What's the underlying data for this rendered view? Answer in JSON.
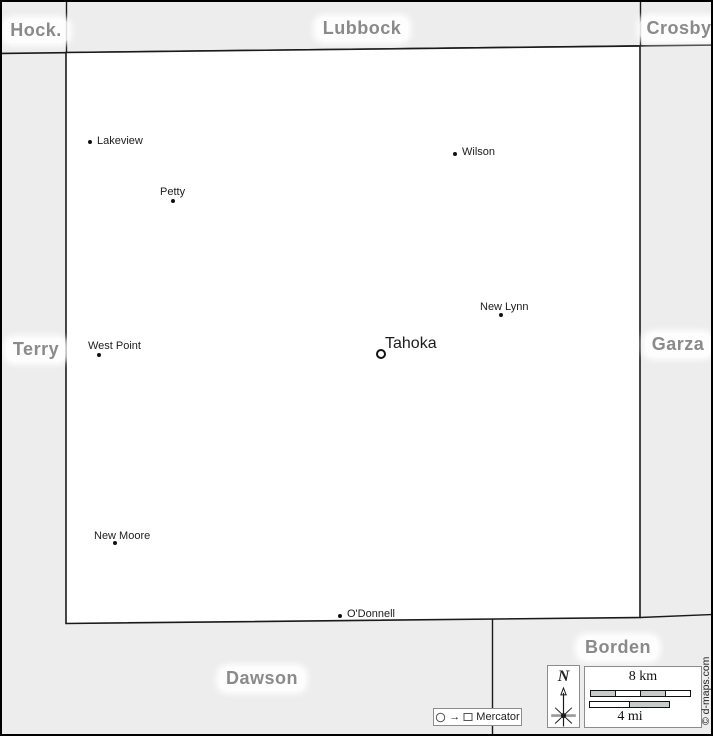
{
  "counties": [
    {
      "name": "Hock.",
      "cx": 34,
      "cy": 17
    },
    {
      "name": "Lubbock",
      "cx": 360,
      "cy": 15
    },
    {
      "name": "Crosby",
      "cx": 677,
      "cy": 15
    },
    {
      "name": "Terry",
      "cx": 34,
      "cy": 336
    },
    {
      "name": "Garza",
      "cx": 676,
      "cy": 331
    },
    {
      "name": "Dawson",
      "cx": 260,
      "cy": 665
    },
    {
      "name": "Borden",
      "cx": 616,
      "cy": 634
    }
  ],
  "towns": [
    {
      "name": "Lakeview",
      "seat": false,
      "dot_x": 88,
      "dot_y": 140,
      "label_x": 95,
      "label_y": 133
    },
    {
      "name": "Petty",
      "seat": false,
      "dot_x": 171,
      "dot_y": 199,
      "label_x": 158,
      "label_y": 184
    },
    {
      "name": "Wilson",
      "seat": false,
      "dot_x": 453,
      "dot_y": 152,
      "label_x": 460,
      "label_y": 144
    },
    {
      "name": "New Lynn",
      "seat": false,
      "dot_x": 499,
      "dot_y": 313,
      "label_x": 478,
      "label_y": 299
    },
    {
      "name": "West Point",
      "seat": false,
      "dot_x": 97,
      "dot_y": 353,
      "label_x": 86,
      "label_y": 338
    },
    {
      "name": "Tahoka",
      "seat": true,
      "dot_x": 379,
      "dot_y": 352,
      "label_x": 383,
      "label_y": 333
    },
    {
      "name": "New Moore",
      "seat": false,
      "dot_x": 113,
      "dot_y": 541,
      "label_x": 92,
      "label_y": 528
    },
    {
      "name": "O'Donnell",
      "seat": false,
      "dot_x": 338,
      "dot_y": 614,
      "label_x": 345,
      "label_y": 606
    }
  ],
  "legend": {
    "north_label": "N",
    "scale_km_label": "8 km",
    "scale_mi_label": "4 mi",
    "projection_label": "Mercator",
    "credit": "© d-maps.com"
  },
  "icons": {
    "projection_arrow": "→"
  },
  "colors": {
    "background": "#ededee",
    "map_fill": "#ffffff",
    "boundary_line": "#1a1a1a",
    "county_label_text": "#8a8a8a",
    "town_label_text": "#1c1c1c",
    "scale_segment_gray": "#c7cbca",
    "widget_border": "#8c8c8c"
  }
}
